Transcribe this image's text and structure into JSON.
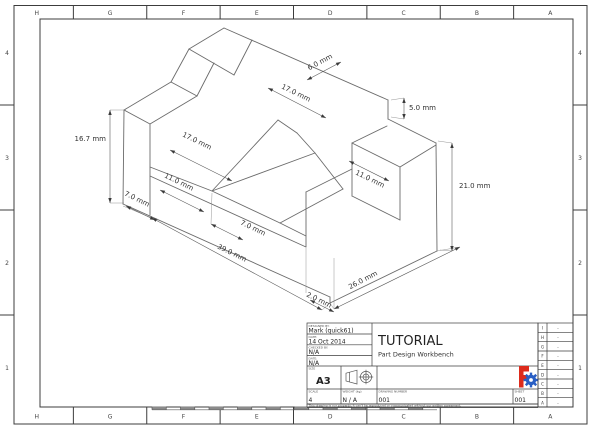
{
  "sheet": {
    "name": "technical-drawing-sheet",
    "paper_size_label": "A3",
    "border_letters": [
      "H",
      "G",
      "F",
      "E",
      "D",
      "C",
      "B",
      "A"
    ],
    "border_numbers": [
      "4",
      "3",
      "2",
      "1"
    ]
  },
  "dimensions": [
    {
      "label": "16.7 mm"
    },
    {
      "label": "7.0 mm"
    },
    {
      "label": "17.0 mm"
    },
    {
      "label": "11.0 mm"
    },
    {
      "label": "17.0 mm"
    },
    {
      "label": "6.0 mm"
    },
    {
      "label": "5.0 mm"
    },
    {
      "label": "11.0 mm"
    },
    {
      "label": "21.0 mm"
    },
    {
      "label": "7.0 mm"
    },
    {
      "label": "39.0 mm"
    },
    {
      "label": "26.0 mm"
    },
    {
      "label": "2.0 mm"
    }
  ],
  "title_block": {
    "designed_by_label": "DESIGNED BY:",
    "designed_by": "Mark  (quick61)",
    "date_label": "DATE:",
    "date": "14 Oct 2014",
    "checked_by_label": "CHECKED BY:",
    "checked_by": "N/A",
    "date2_label": "DATE:",
    "date2": "N/A",
    "size_label": "SIZE",
    "size": "A3",
    "title": "TUTORIAL",
    "subtitle": "Part Design Workbench",
    "scale_label": "SCALE",
    "scale": "4",
    "weight_label": "WEIGHT (kg)",
    "weight": "N / A",
    "drawing_number_label": "DRAWING NUMBER",
    "drawing_number": "001",
    "sheet_label": "SHEET",
    "sheet": "001",
    "disclaimer": "This drawing is our property; it can't be reproduced or communicated without our written agreement.",
    "revision_rows": [
      {
        "letter": "I",
        "value": "-"
      },
      {
        "letter": "H",
        "value": "-"
      },
      {
        "letter": "G",
        "value": "-"
      },
      {
        "letter": "F",
        "value": "-"
      },
      {
        "letter": "E",
        "value": "-"
      },
      {
        "letter": "D",
        "value": "-"
      },
      {
        "letter": "C",
        "value": "-"
      },
      {
        "letter": "B",
        "value": "-"
      },
      {
        "letter": "A",
        "value": "-"
      }
    ],
    "logo": {
      "name": "freecad-logo",
      "red": "#dd2b1c",
      "blue": "#2a5fc4"
    }
  }
}
